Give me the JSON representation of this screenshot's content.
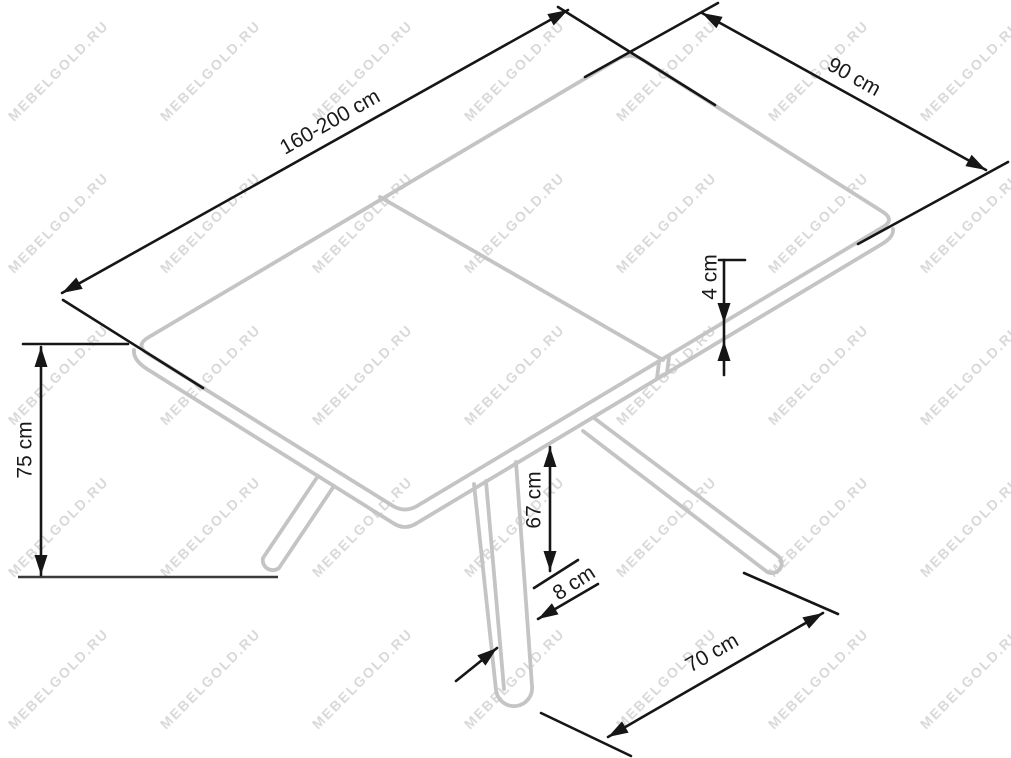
{
  "watermark": {
    "text": "MEBELGOLD.RU",
    "color": "#d9d9d9"
  },
  "diagram": {
    "subject": "extendable dining table with X-pedestal base - dimension drawing",
    "unit": "cm",
    "colors": {
      "outline": "#c4c4c4",
      "dimension": "#161616",
      "label": "#1a1a1a",
      "ground": "#3a3a3a",
      "background": "#ffffff"
    },
    "dimensions": [
      {
        "id": "length",
        "label": "160-200 cm",
        "value": "160-200",
        "measures": "tabletop length (extendable)"
      },
      {
        "id": "width",
        "label": "90 cm",
        "value": "90",
        "measures": "tabletop width"
      },
      {
        "id": "thickness",
        "label": "4 cm",
        "value": "4",
        "measures": "tabletop thickness"
      },
      {
        "id": "height",
        "label": "75 cm",
        "value": "75",
        "measures": "overall table height"
      },
      {
        "id": "clearance",
        "label": "67 cm",
        "value": "67",
        "measures": "clearance under tabletop"
      },
      {
        "id": "leg-width",
        "label": "8 cm",
        "value": "8",
        "measures": "leg width"
      },
      {
        "id": "base-spread",
        "label": "70 cm",
        "value": "70",
        "measures": "distance between feet"
      }
    ]
  }
}
